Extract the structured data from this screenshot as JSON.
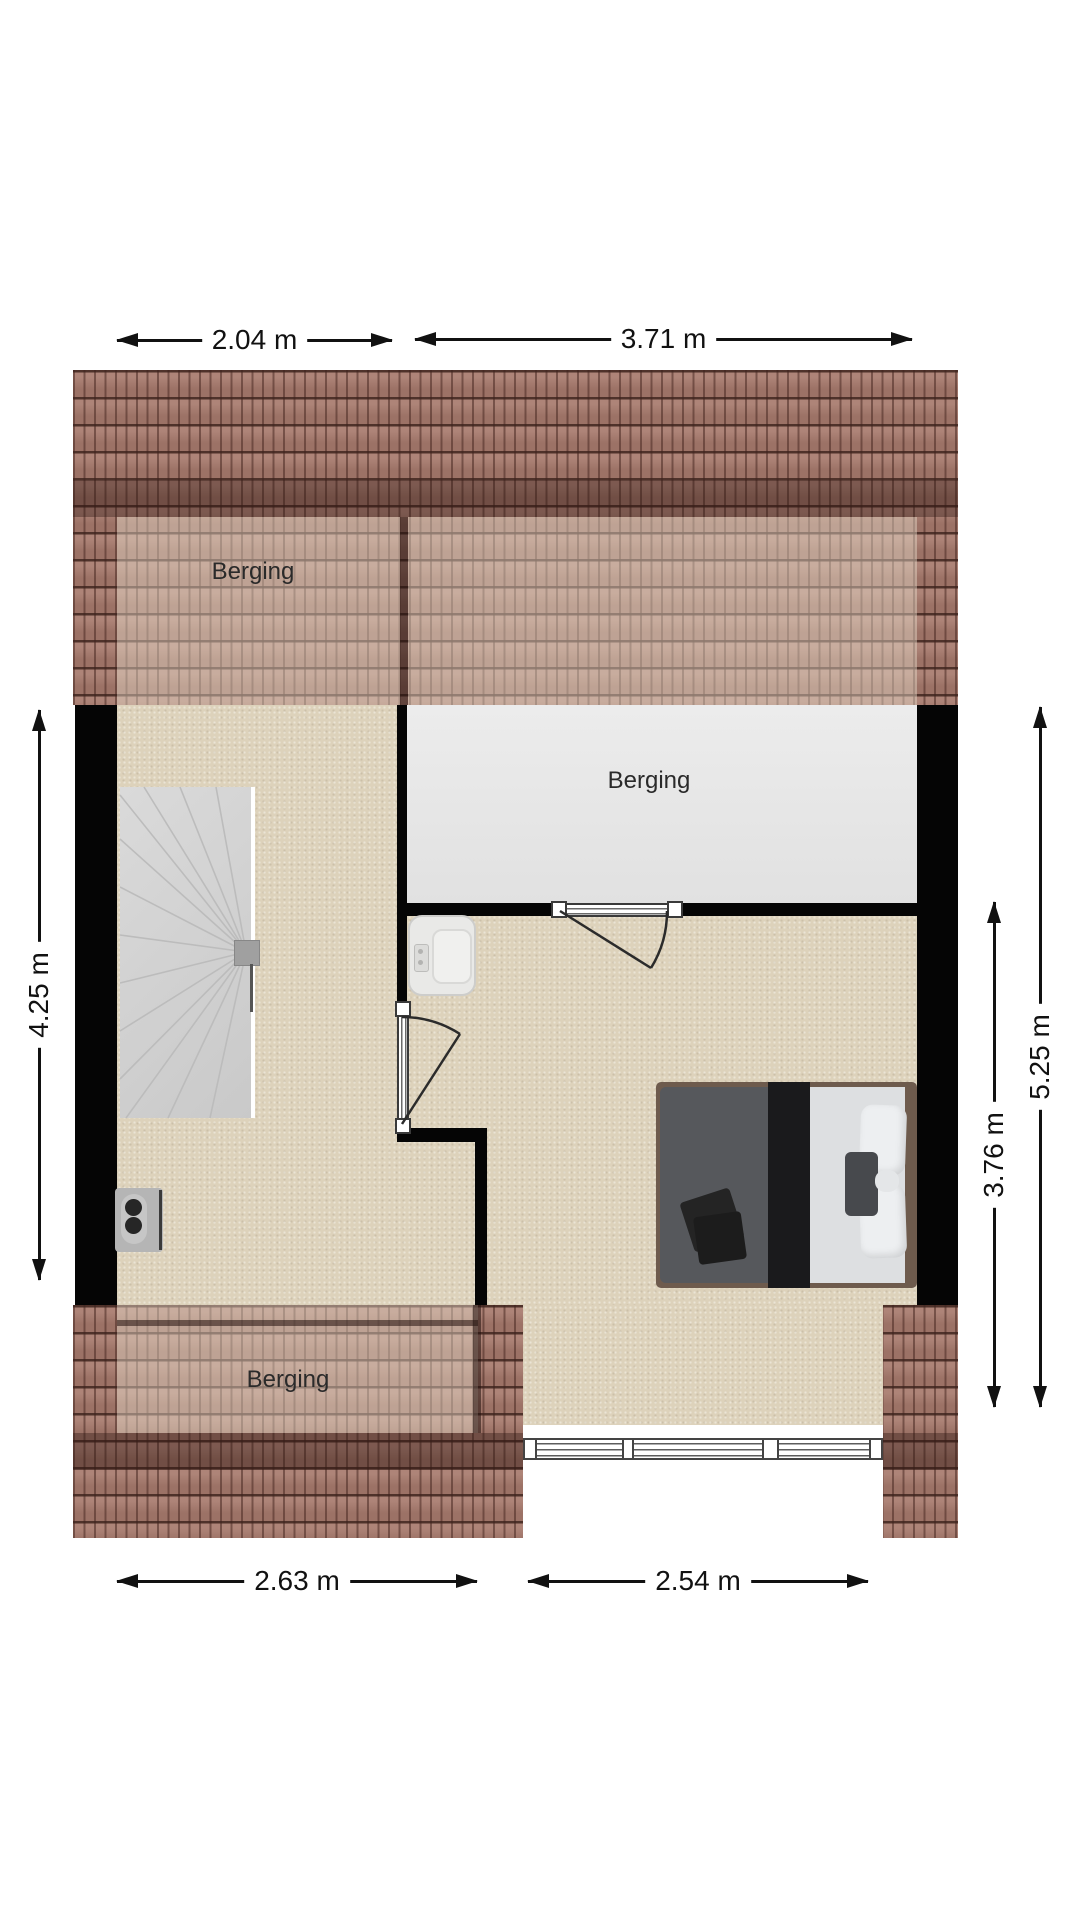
{
  "plan": {
    "rooms": {
      "top_storage": {
        "label": "Berging"
      },
      "middle_storage": {
        "label": "Berging"
      },
      "bottom_storage": {
        "label": "Berging"
      }
    },
    "dimensions": {
      "top": [
        {
          "label": "2.04 m"
        },
        {
          "label": "3.71 m"
        }
      ],
      "left": [
        {
          "label": "4.25 m"
        }
      ],
      "right": [
        {
          "label": "3.76 m"
        },
        {
          "label": "5.25 m"
        }
      ],
      "bottom": [
        {
          "label": "2.63 m"
        },
        {
          "label": "2.54 m"
        }
      ]
    },
    "colors": {
      "background": "#ffffff",
      "wall": "#050505",
      "roof_tile": "#a87b6e",
      "roof_line": "#462822",
      "floor": "#ddd2bb",
      "storage_floor": "#e6e6e6",
      "stairs": "#d2d2d2",
      "dimension_ink": "#111111",
      "bed_duvet": "#56585c",
      "bed_sheet": "#dddfe1",
      "bed_frame": "#6e5b4d"
    },
    "furniture": {
      "stairs": "winder-staircase",
      "toilet": "toilet",
      "outlet": "wall-socket",
      "bed": "double-bed",
      "window": "dormer-window",
      "doors": [
        "storage-room-door",
        "hall-door"
      ]
    }
  }
}
